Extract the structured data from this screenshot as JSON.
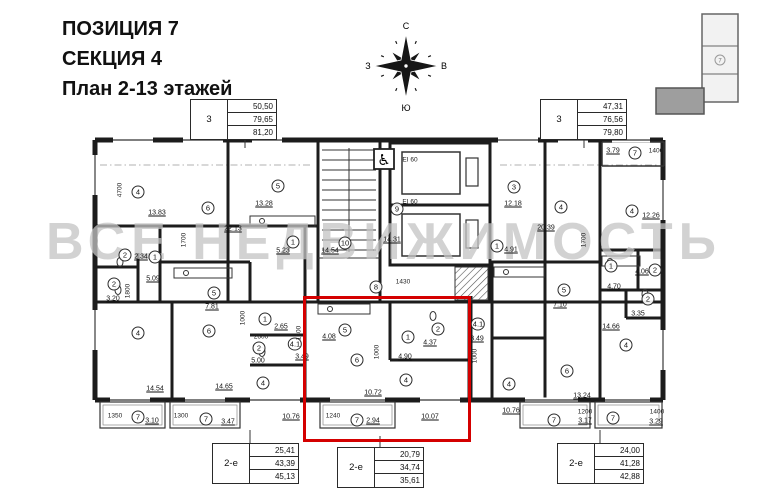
{
  "title": {
    "line1": "ПОЗИЦИЯ 7",
    "line2": "СЕКЦИЯ 4",
    "line3": "План 2-13 этажей"
  },
  "compass": {
    "north": "С",
    "south": "Ю",
    "west": "З",
    "east": "В"
  },
  "keyplan": {
    "section_label": "7"
  },
  "watermark": {
    "text": "ВСЕ НЕДВИЖИМОСТЬ"
  },
  "accessibility_icon": "♿",
  "colors": {
    "highlight": "#d40000",
    "walls": "#1c1c1c",
    "watermark": "#c3c3c3"
  },
  "summary_boxes": [
    {
      "type": "3",
      "values": [
        "50,50",
        "79,65",
        "81,20"
      ]
    },
    {
      "type": "3",
      "values": [
        "47,31",
        "76,56",
        "79,80"
      ]
    },
    {
      "type": "2-е",
      "values": [
        "25,41",
        "43,39",
        "45,13"
      ]
    },
    {
      "type": "2-е",
      "values": [
        "20,79",
        "34,74",
        "35,61"
      ]
    },
    {
      "type": "2-е",
      "values": [
        "24,00",
        "41,28",
        "42,88"
      ]
    }
  ],
  "rooms": [
    {
      "n": "4",
      "a": "13.83",
      "x": 138,
      "y": 192,
      "ax": 157,
      "ay": 213
    },
    {
      "n": "6",
      "a": "22.13",
      "x": 208,
      "y": 208,
      "ax": 233,
      "ay": 229
    },
    {
      "n": "5",
      "a": "13.28",
      "x": 278,
      "y": 186,
      "ax": 264,
      "ay": 204
    },
    {
      "n": "2",
      "a": "2.34",
      "x": 125,
      "y": 255,
      "ax": 141,
      "ay": 257
    },
    {
      "n": "1",
      "a": "5.09",
      "x": 155,
      "y": 257,
      "ax": 153,
      "ay": 279
    },
    {
      "n": "2",
      "a": "3.20",
      "x": 114,
      "y": 284,
      "ax": 113,
      "ay": 299
    },
    {
      "n": "1",
      "a": "5.23",
      "x": 293,
      "y": 242,
      "ax": 283,
      "ay": 251
    },
    {
      "n": "10",
      "a": "14.54",
      "x": 345,
      "y": 243,
      "ax": 330,
      "ay": 251
    },
    {
      "n": "9",
      "a": "14.31",
      "x": 397,
      "y": 209,
      "ax": 392,
      "ay": 240
    },
    {
      "n": "8",
      "a": "",
      "x": 376,
      "y": 287
    },
    {
      "n": "3",
      "a": "12.18",
      "x": 514,
      "y": 187,
      "ax": 513,
      "ay": 204
    },
    {
      "n": "4",
      "a": "20.39",
      "x": 561,
      "y": 207,
      "ax": 546,
      "ay": 228
    },
    {
      "n": "1",
      "a": "4.91",
      "x": 497,
      "y": 246,
      "ax": 511,
      "ay": 250
    },
    {
      "n": "4",
      "a": "12.26",
      "x": 632,
      "y": 211,
      "ax": 651,
      "ay": 216
    },
    {
      "n": "7",
      "a": "3.79",
      "x": 635,
      "y": 153,
      "ax": 613,
      "ay": 151
    },
    {
      "n": "1",
      "a": "4.70",
      "x": 611,
      "y": 266,
      "ax": 614,
      "ay": 287
    },
    {
      "n": "2",
      "a": "4.06",
      "x": 655,
      "y": 270,
      "ax": 642,
      "ay": 272
    },
    {
      "n": "2",
      "a": "3.35",
      "x": 648,
      "y": 299,
      "ax": 638,
      "ay": 314
    },
    {
      "n": "5",
      "a": "7.10",
      "x": 564,
      "y": 290,
      "ax": 560,
      "ay": 305
    },
    {
      "n": "4",
      "a": "14.66",
      "x": 626,
      "y": 345,
      "ax": 611,
      "ay": 327
    },
    {
      "n": "6",
      "a": "13.24",
      "x": 567,
      "y": 371,
      "ax": 582,
      "ay": 396
    },
    {
      "n": "4",
      "a": "10.76",
      "x": 509,
      "y": 384,
      "ax": 511,
      "ay": 411
    },
    {
      "n": "7",
      "a": "3.17",
      "x": 554,
      "y": 420,
      "ax": 585,
      "ay": 421
    },
    {
      "n": "7",
      "a": "3.29",
      "x": 613,
      "y": 418,
      "ax": 656,
      "ay": 422
    },
    {
      "n": "4",
      "a": "14.54",
      "x": 138,
      "y": 333,
      "ax": 155,
      "ay": 389
    },
    {
      "n": "5",
      "a": "7.81",
      "x": 214,
      "y": 293,
      "ax": 212,
      "ay": 307
    },
    {
      "n": "6",
      "a": "14.65",
      "x": 209,
      "y": 331,
      "ax": 224,
      "ay": 387
    },
    {
      "n": "1",
      "a": "2.65",
      "x": 265,
      "y": 319,
      "ax": 281,
      "ay": 327
    },
    {
      "n": "2",
      "a": "5.00",
      "x": 259,
      "y": 348,
      "ax": 258,
      "ay": 361
    },
    {
      "n": "7",
      "a": "3.10",
      "x": 138,
      "y": 417,
      "ax": 152,
      "ay": 421
    },
    {
      "n": "7",
      "a": "3.47",
      "x": 206,
      "y": 419,
      "ax": 228,
      "ay": 422
    },
    {
      "n": "4",
      "a": "10.76",
      "x": 263,
      "y": 383,
      "ax": 291,
      "ay": 417
    },
    {
      "n": "5",
      "a": "4.08",
      "x": 345,
      "y": 330,
      "ax": 329,
      "ay": 337
    },
    {
      "n": "1",
      "a": "4.90",
      "x": 408,
      "y": 337,
      "ax": 405,
      "ay": 357
    },
    {
      "n": "2",
      "a": "4.37",
      "x": 438,
      "y": 329,
      "ax": 430,
      "ay": 343
    },
    {
      "n": "6",
      "a": "10.72",
      "x": 357,
      "y": 360,
      "ax": 373,
      "ay": 393
    },
    {
      "n": "4",
      "a": "10.07",
      "x": 406,
      "y": 380,
      "ax": 430,
      "ay": 417
    },
    {
      "n": "7",
      "a": "2.94",
      "x": 357,
      "y": 420,
      "ax": 373,
      "ay": 421
    },
    {
      "n": "4.1",
      "a": "3.49",
      "x": 295,
      "y": 344,
      "ax": 302,
      "ay": 357
    },
    {
      "n": "4.1",
      "a": "3.49",
      "x": 478,
      "y": 324,
      "ax": 477,
      "ay": 339
    }
  ],
  "dimensions": [
    {
      "t": "4700",
      "x": 120,
      "y": 190,
      "r": 90
    },
    {
      "t": "1700",
      "x": 184,
      "y": 240,
      "r": 90
    },
    {
      "t": "1700",
      "x": 584,
      "y": 240,
      "r": 90
    },
    {
      "t": "1800",
      "x": 128,
      "y": 291,
      "r": 90
    },
    {
      "t": "1000",
      "x": 243,
      "y": 318,
      "r": 90
    },
    {
      "t": "1000",
      "x": 377,
      "y": 352,
      "r": 90
    },
    {
      "t": "1000",
      "x": 475,
      "y": 356,
      "r": 90
    },
    {
      "t": "1300",
      "x": 299,
      "y": 333,
      "r": 90
    },
    {
      "t": "2600",
      "x": 261,
      "y": 337,
      "r": 0
    },
    {
      "t": "1430",
      "x": 403,
      "y": 282,
      "r": 0
    },
    {
      "t": "1400",
      "x": 656,
      "y": 151,
      "r": 0
    },
    {
      "t": "1350",
      "x": 115,
      "y": 416,
      "r": 0
    },
    {
      "t": "1300",
      "x": 181,
      "y": 416,
      "r": 0
    },
    {
      "t": "1240",
      "x": 333,
      "y": 416,
      "r": 0
    },
    {
      "t": "1200",
      "x": 585,
      "y": 412,
      "r": 0
    },
    {
      "t": "1400",
      "x": 657,
      "y": 412,
      "r": 0
    },
    {
      "t": "EI 60",
      "x": 410,
      "y": 160,
      "r": 0
    },
    {
      "t": "EI 60",
      "x": 410,
      "y": 202,
      "r": 0
    }
  ]
}
